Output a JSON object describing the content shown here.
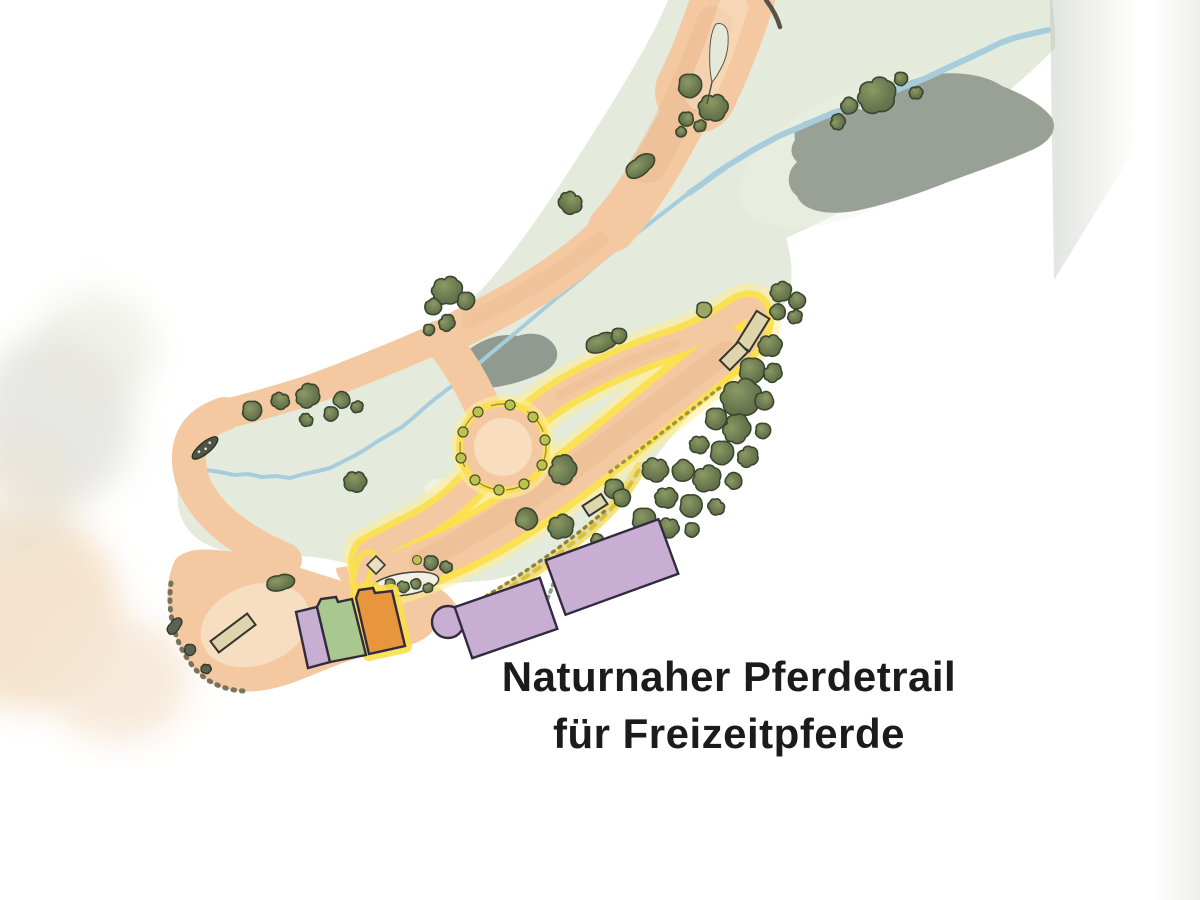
{
  "caption": {
    "line1": "Naturnaher Pferdetrail",
    "line2": "für Freizeitpferde",
    "color": "#1b1b1b"
  },
  "palette": {
    "background": "#ffffff",
    "meadow": "#e4ebdc",
    "meadow_light": "#eef2e6",
    "path_sand": "#f4c9a1",
    "path_sand_dark": "#e9b78c",
    "path_sand_light": "#f8e0c4",
    "trail_yellow": "#fbdf4c",
    "trail_glow": "#ffef92",
    "stream_blue": "#a7cddc",
    "wet_gray": "#99a197",
    "bush_fill": "#6d7b55",
    "bush_stroke": "#3b462e",
    "bush_light": "#9aa662",
    "bush_yellow": "#bcc24d",
    "stone": "#5c6252",
    "building_lilac": "#c9aed3",
    "building_green": "#a9c88f",
    "building_orange": "#e8963e",
    "building_outline": "#322a3e",
    "obstacle_beige": "#ded5ad",
    "obstacle_outline": "#35352b",
    "road_line": "#5a524a",
    "stipple": "#60604f",
    "caption_color": "#1b1b1b"
  }
}
